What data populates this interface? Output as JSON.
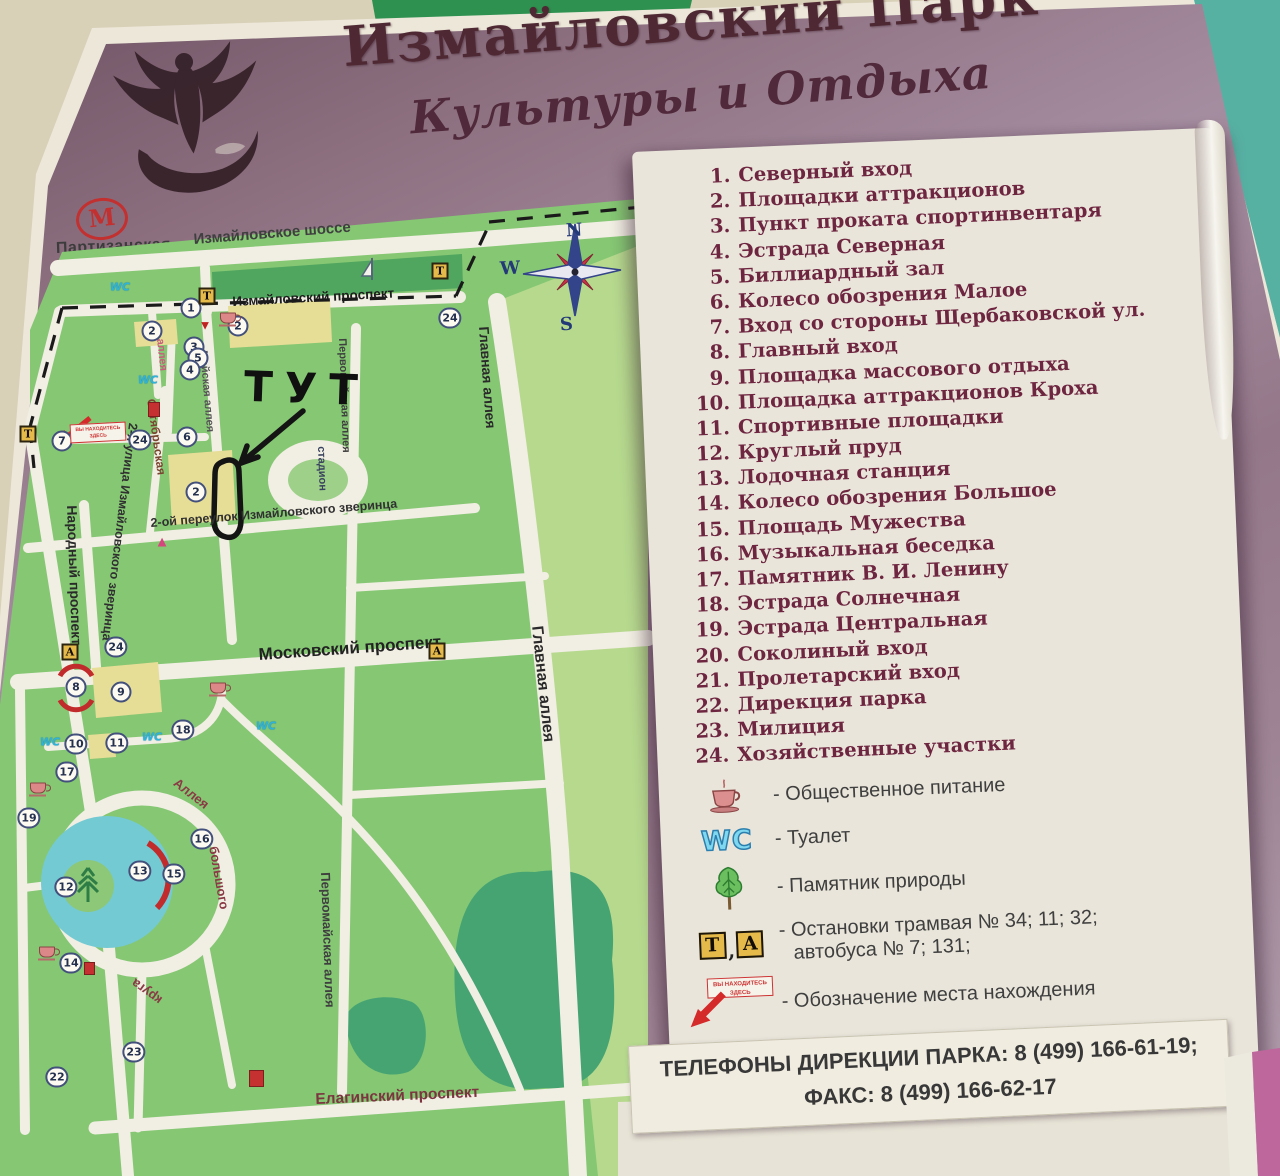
{
  "title": {
    "line1": "Измайловский Парк",
    "line2": "Культуры и Отдыха"
  },
  "metro": {
    "symbol": "М",
    "station": "Партизанская"
  },
  "compass": {
    "n": "N",
    "e": "E",
    "s": "S",
    "w": "W"
  },
  "annotation": {
    "here_text": "ТУТ"
  },
  "you_are_here": {
    "line1": "ВЫ НАХОДИТЕСЬ",
    "line2": "ЗДЕСЬ"
  },
  "map": {
    "wc": "WC",
    "stadium": "стадион",
    "streets": [
      "Измайловское шоссе",
      "Измайловский проспект",
      "Главная аллея",
      "Главная аллея",
      "Московский проспект",
      "Елагинский проспект",
      "2-ой переулок Измайловского зверинца",
      "2-я улица Измайловского зверинца",
      "Народный проспект",
      "Майская аллея",
      "Октябрьская",
      "аллея",
      "Первомайская аллея",
      "Первомайская аллея",
      "стадион",
      "Аллея",
      "большого",
      "круга"
    ],
    "markers": [
      "1",
      "2",
      "2",
      "2",
      "3",
      "5",
      "4",
      "6",
      "7",
      "8",
      "9",
      "10",
      "11",
      "12",
      "13",
      "14",
      "15",
      "16",
      "17",
      "18",
      "19",
      "22",
      "23",
      "24",
      "24",
      "24"
    ],
    "stops": [
      "Т",
      "Т",
      "Т",
      "А",
      "А"
    ]
  },
  "legend": {
    "items": [
      {
        "num": "1.",
        "text": "Северный вход"
      },
      {
        "num": "2.",
        "text": "Площадки аттракционов"
      },
      {
        "num": "3.",
        "text": "Пункт проката спортинвентаря"
      },
      {
        "num": "4.",
        "text": "Эстрада Северная"
      },
      {
        "num": "5.",
        "text": "Биллиардный зал"
      },
      {
        "num": "6.",
        "text": "Колесо обозрения Малое"
      },
      {
        "num": "7.",
        "text": "Вход со стороны Щербаковской ул."
      },
      {
        "num": "8.",
        "text": "Главный вход"
      },
      {
        "num": "9.",
        "text": "Площадка массового отдыха"
      },
      {
        "num": "10.",
        "text": "Площадка аттракционов Кроха"
      },
      {
        "num": "11.",
        "text": "Спортивные площадки"
      },
      {
        "num": "12.",
        "text": "Круглый пруд"
      },
      {
        "num": "13.",
        "text": "Лодочная станция"
      },
      {
        "num": "14.",
        "text": "Колесо обозрения Большое"
      },
      {
        "num": "15.",
        "text": "Площадь Мужества"
      },
      {
        "num": "16.",
        "text": "Музыкальная беседка"
      },
      {
        "num": "17.",
        "text": "Памятник В. И. Ленину"
      },
      {
        "num": "18.",
        "text": "Эстрада Солнечная"
      },
      {
        "num": "19.",
        "text": "Эстрада Центральная"
      },
      {
        "num": "20.",
        "text": "Соколиный вход"
      },
      {
        "num": "21.",
        "text": "Пролетарский вход"
      },
      {
        "num": "22.",
        "text": "Дирекция парка"
      },
      {
        "num": "23.",
        "text": "Милиция"
      },
      {
        "num": "24.",
        "text": "Хозяйственные участки"
      }
    ],
    "symbols": {
      "food": "- Общественное питание",
      "wc_label": "WC",
      "wc": "- Туалет",
      "tree": "- Памятник природы",
      "stop_t": "Т",
      "stop_a": "А",
      "stop_sep": ",",
      "stops_line1": "- Остановки трамвая № 34; 11; 32;",
      "stops_line2": "автобуса № 7; 131;",
      "location": "- Обозначение места нахождения",
      "ksc_abbr": "КСЦ",
      "ksc_text": "- Конно спортивный центр Измайлово",
      "ksc_phone": "тел. 109-90-88 факс 176-78-35"
    }
  },
  "footer": {
    "phones_line1": "ТЕЛЕФОНЫ ДИРЕКЦИИ ПАРКА: 8 (499) 166-61-19;",
    "phones_line2": "ФАКС:  8 (499) 166-62-17"
  },
  "colors": {
    "board": "#94788a",
    "map_green": "#85c773",
    "pond": "#74cad3",
    "paper": "#e9e5da",
    "accent": "#6e2540"
  }
}
